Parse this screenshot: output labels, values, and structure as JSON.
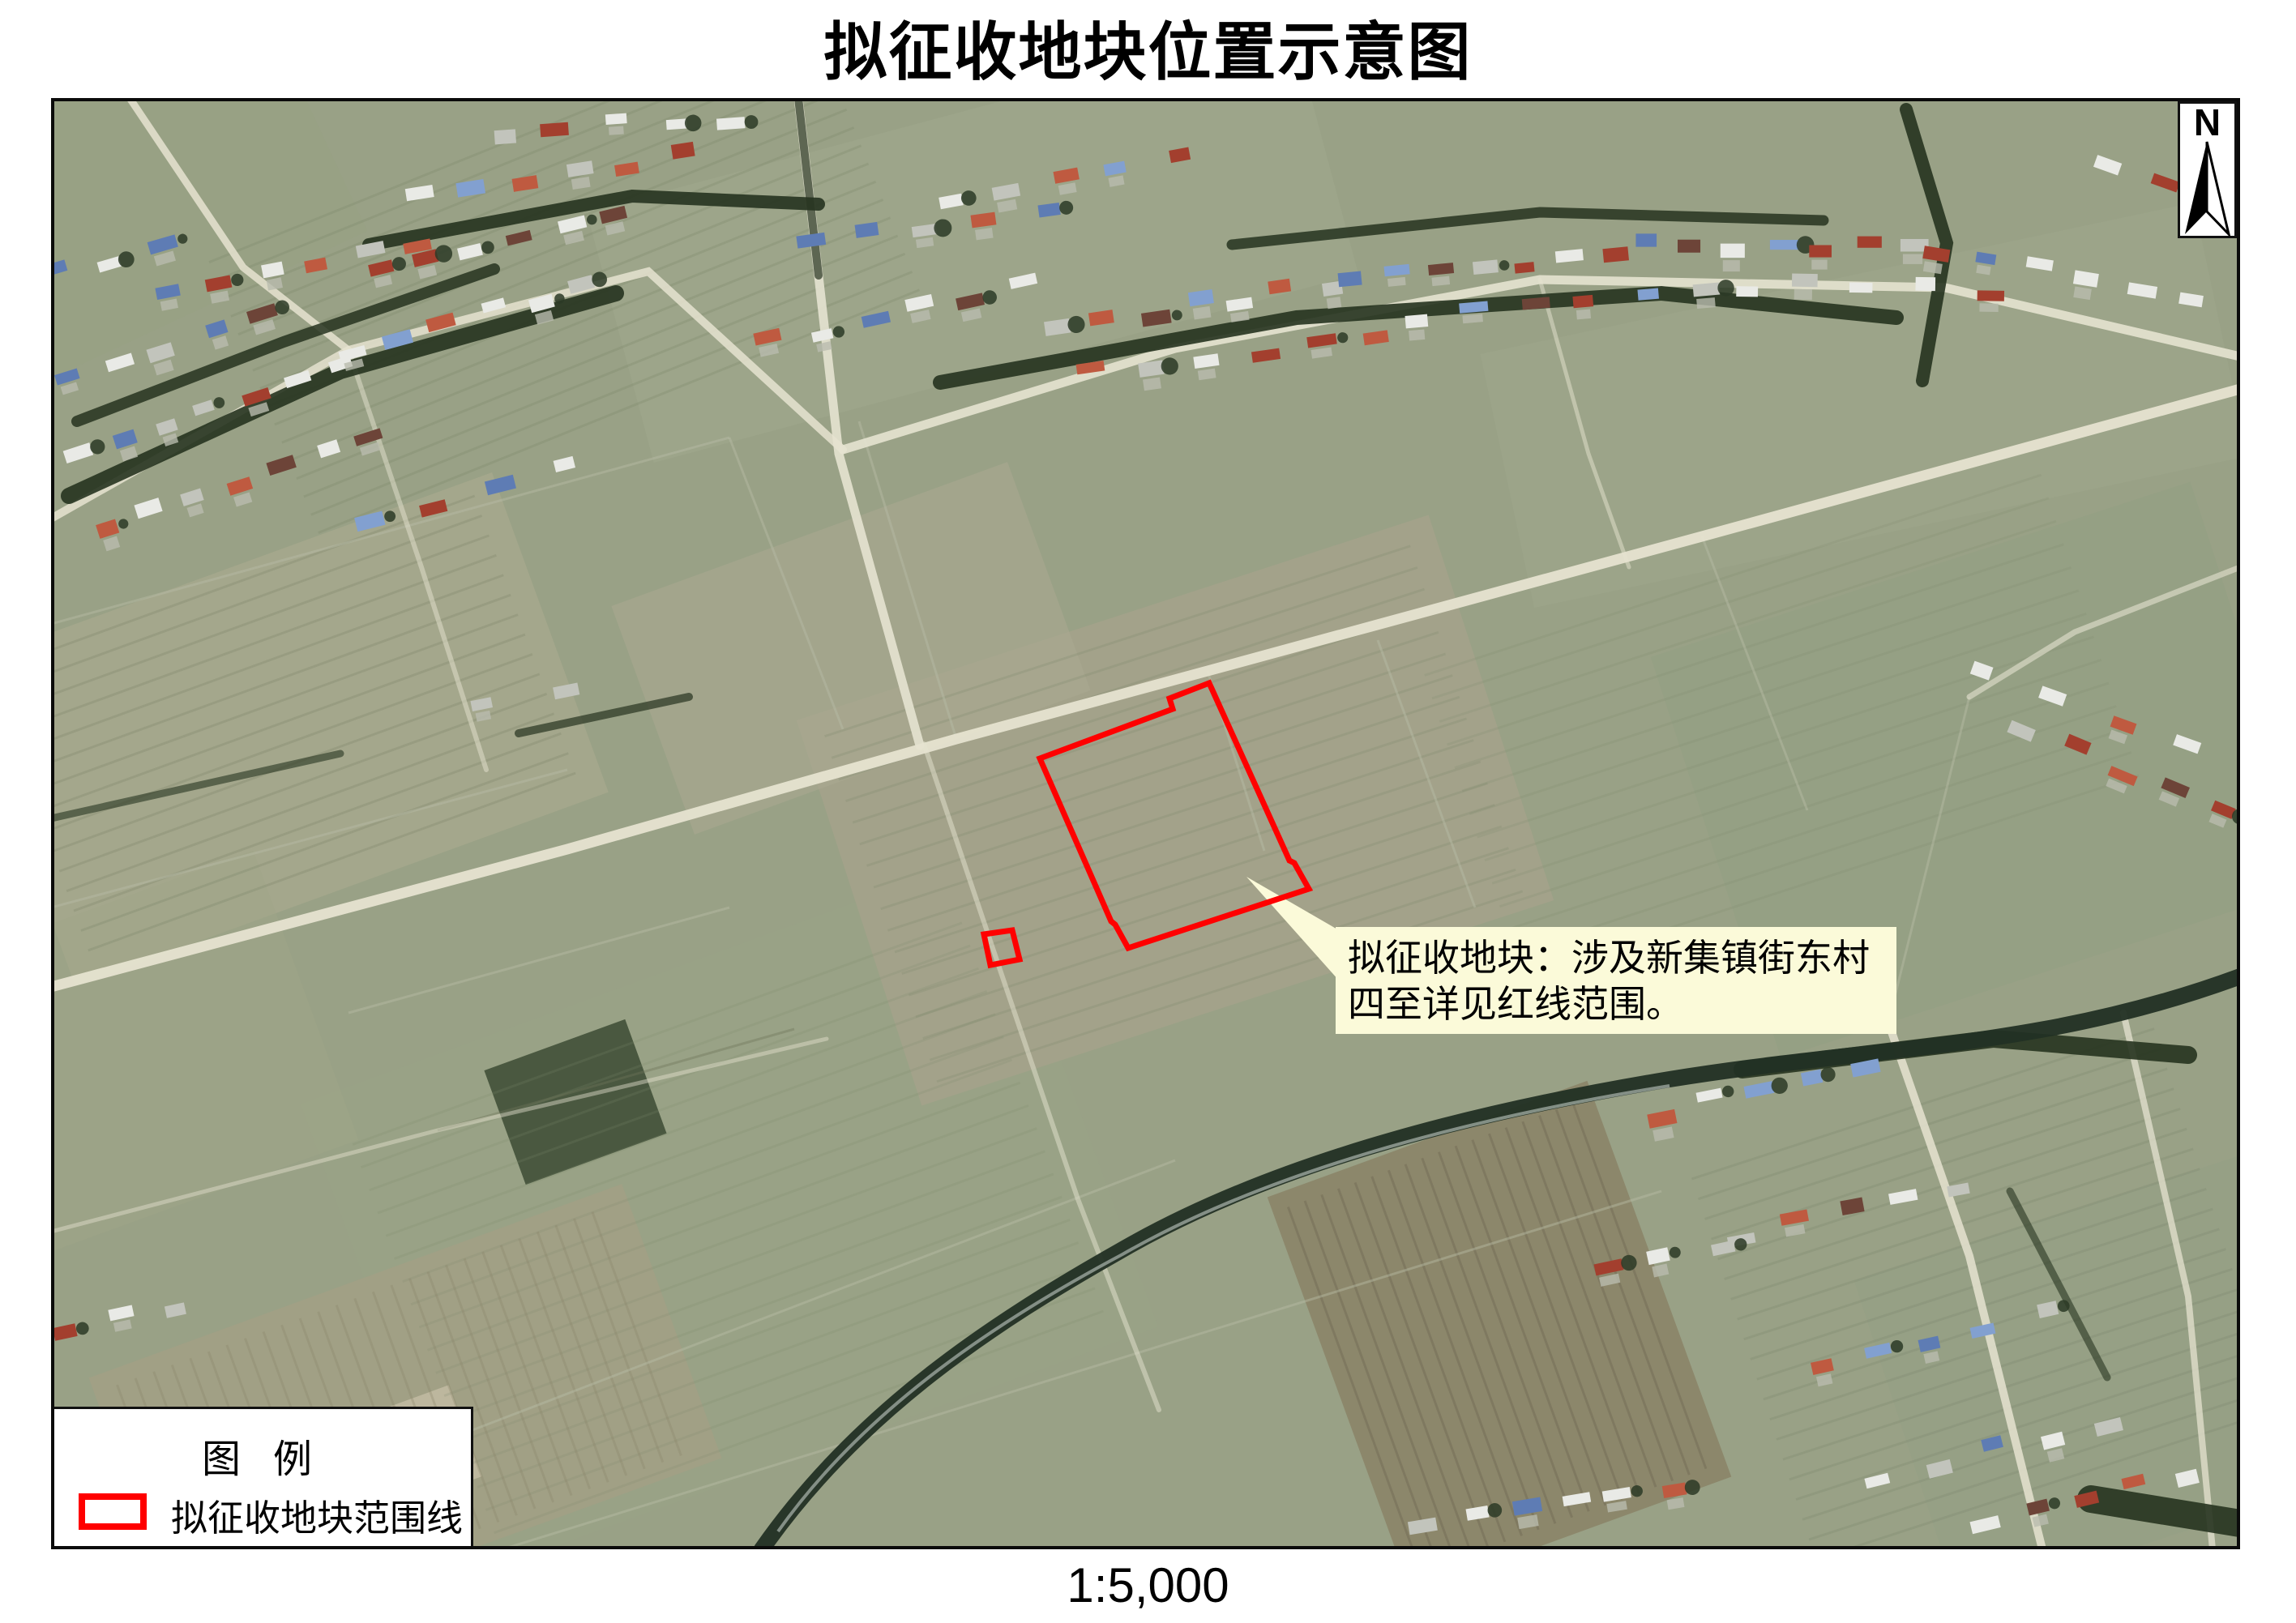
{
  "page": {
    "title": "拟征收地块位置示意图",
    "scale_label": "1:5,000"
  },
  "map": {
    "north_indicator": {
      "label": "N",
      "icon": "north-arrow-icon"
    },
    "callout": {
      "lines": [
        "拟征收地块：涉及新集镇街东村",
        "四至详见红线范围。"
      ],
      "background_color": "#fbfad9"
    },
    "legend": {
      "title": "图 例",
      "items": [
        {
          "label": "拟征收地块范围线",
          "swatch": "red-outline-rect",
          "swatch_color": "#ff0000"
        }
      ]
    },
    "plot_boundary": {
      "color": "#ff0000",
      "stroke_width": 7,
      "main_polygon": [
        [
          1283,
          936
        ],
        [
          1447,
          875
        ],
        [
          1443,
          862
        ],
        [
          1492,
          843
        ],
        [
          1591,
          1062
        ],
        [
          1597,
          1065
        ],
        [
          1615,
          1097
        ],
        [
          1392,
          1170
        ],
        [
          1376,
          1141
        ],
        [
          1371,
          1137
        ]
      ],
      "small_polygon": [
        [
          1214,
          1153
        ],
        [
          1249,
          1148
        ],
        [
          1258,
          1184
        ],
        [
          1222,
          1191
        ]
      ],
      "leader_polygon": [
        [
          1538,
          1082
        ],
        [
          1652,
          1148
        ],
        [
          1652,
          1210
        ]
      ]
    }
  }
}
